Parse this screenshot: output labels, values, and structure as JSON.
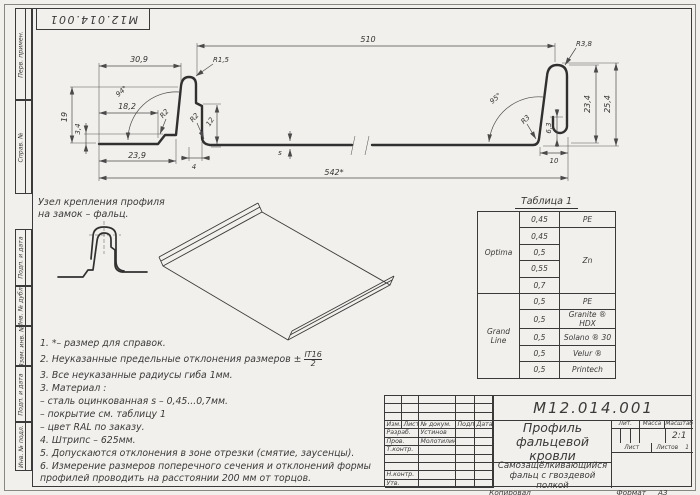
{
  "stamp": {
    "doc_number": "М12.014.001"
  },
  "margins": {
    "perv": "Перв. примен.",
    "sprav": "Справ. №",
    "podp1": "Подп. и дата",
    "dubl": "Инв. № дубл.",
    "vzam": "Взам. инв. №",
    "podp2": "Подп. и дата",
    "podl": "Инв. № подл."
  },
  "detail_label": {
    "line1": "Узел крепления профиля",
    "line2": "на замок – фальц."
  },
  "dims": {
    "w510": "510",
    "w542": "542*",
    "w309": "30,9",
    "w239": "23,9",
    "w182": "18,2",
    "h19": "19",
    "h34": "3,4",
    "a94": "94°",
    "r15": "R1,5",
    "r2_step": "R2",
    "r2_bottom": "R2",
    "h12": "12",
    "w4": "4",
    "s_label": "s",
    "a95": "95°",
    "r3": "R3",
    "r38": "R3,8",
    "h234": "23,4",
    "h254": "25,4",
    "h63": "6,3",
    "w10": "10"
  },
  "notes": {
    "n1": "1.  *– размер для справок.",
    "n2": "2.  Неуказанные предельные отклонения размеров ±",
    "n2_num": "IT16",
    "n2_den": "2",
    "n3a": "3.  Все неуказанные радиусы гиба 1мм.",
    "n3b": "3.  Материал :",
    "mat1": "–  сталь оцинкованная s – 0,45...0,7мм.",
    "mat2": "–  покрытие см. таблицу 1",
    "mat3": "–  цвет RAL по заказу.",
    "n4": "4.  Штрипс – 625мм.",
    "n5": "5.  Допускаются отклонения в зоне отрезки (смятие, заусенцы).",
    "n6": "6.  Измерение размеров поперечного сечения и отклонений формы профилей проводить на расстоянии 200 мм от торцов."
  },
  "table1": {
    "title": "Таблица 1",
    "brand1": "Optima",
    "brand2": "Grand Line",
    "t1": "0,45",
    "t2": "0,45",
    "t3": "0,5",
    "t4": "0,55",
    "t5": "0,7",
    "t6": "0,5",
    "t7": "0,5",
    "t8": "0,5",
    "t9": "0,5",
    "t10": "0,5",
    "c1": "PE",
    "c2": "Zn",
    "c6": "PE",
    "c7": "Granite ® HDX",
    "c8": "Solano ® 30",
    "c9": "Velur ®",
    "c10": "Printech"
  },
  "titleblock": {
    "doc_number": "М12.014.001",
    "name": "Профиль фальцевой кровли",
    "subtitle": "Самозащёлкивающийся фальц с гвоздевой полкой",
    "col_izm": "Изм.",
    "col_list": "Лист",
    "col_doc": "№ докум.",
    "col_podp": "Подп.",
    "col_data": "Дата",
    "role1": "Разраб.",
    "name1": "Устинов",
    "role2": "Пров.",
    "name2": "Молотилин",
    "role3": "Т.контр.",
    "role4": "Н.контр.",
    "role5": "Утв.",
    "lit": "Лит.",
    "massa": "Масса",
    "scale_label": "Масштаб",
    "scale": "2:1",
    "sheet_label": "Лист",
    "sheets_label": "Листов",
    "sheets_value": "1"
  },
  "footer": {
    "kopiroval": "Копировал",
    "format_label": "Формат",
    "format_value": "А3"
  }
}
